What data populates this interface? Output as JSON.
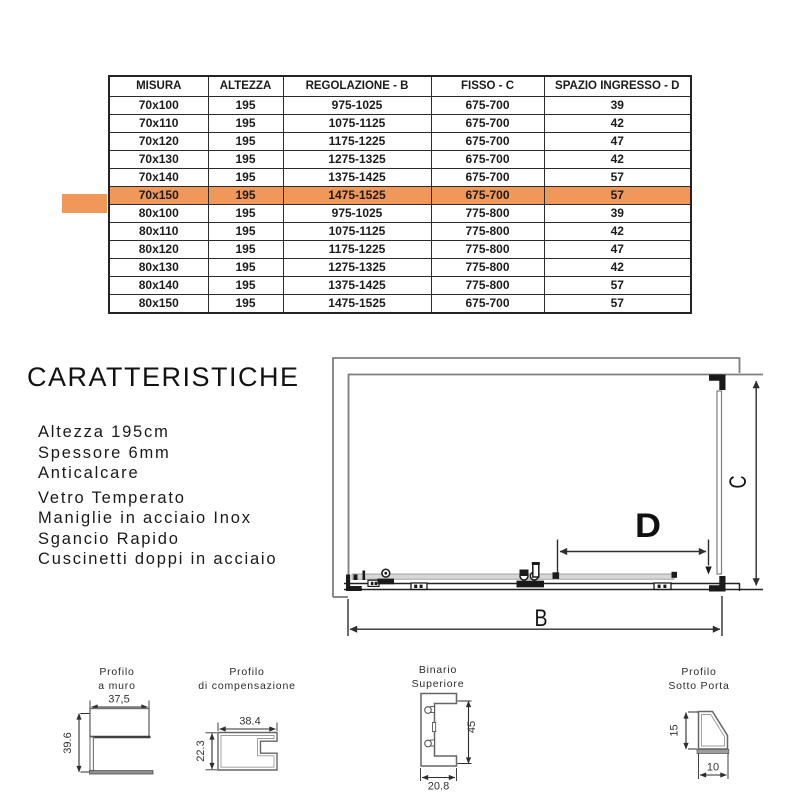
{
  "table": {
    "headers": [
      "MISURA",
      "ALTEZZA",
      "REGOLAZIONE - B",
      "FISSO - C",
      "SPAZIO INGRESSO - D"
    ],
    "rows": [
      [
        "70x100",
        "195",
        "975-1025",
        "675-700",
        "39"
      ],
      [
        "70x110",
        "195",
        "1075-1125",
        "675-700",
        "42"
      ],
      [
        "70x120",
        "195",
        "1175-1225",
        "675-700",
        "47"
      ],
      [
        "70x130",
        "195",
        "1275-1325",
        "675-700",
        "42"
      ],
      [
        "70x140",
        "195",
        "1375-1425",
        "675-700",
        "57"
      ],
      [
        "70x150",
        "195",
        "1475-1525",
        "675-700",
        "57"
      ],
      [
        "80x100",
        "195",
        "975-1025",
        "775-800",
        "39"
      ],
      [
        "80x110",
        "195",
        "1075-1125",
        "775-800",
        "42"
      ],
      [
        "80x120",
        "195",
        "1175-1225",
        "775-800",
        "47"
      ],
      [
        "80x130",
        "195",
        "1275-1325",
        "775-800",
        "42"
      ],
      [
        "80x140",
        "195",
        "1375-1425",
        "775-800",
        "57"
      ],
      [
        "80x150",
        "195",
        "1475-1525",
        "675-700",
        "57"
      ]
    ],
    "highlighted_row_index": 5,
    "highlighted_row": "70x150",
    "highlight_color": "#F0975A"
  },
  "caratteristiche": {
    "title": "CARATTERISTICHE",
    "items": [
      "Altezza 195cm",
      "Spessore 6mm",
      "Anticalcare",
      "Vetro Temperato",
      "Maniglie in acciaio Inox",
      "Sgancio Rapido",
      "Cuscinetti doppi in acciaio"
    ]
  },
  "diagram": {
    "labels": {
      "b": "B",
      "c": "C",
      "d": "D"
    }
  },
  "profiles": [
    {
      "title1": "Profilo",
      "title2": "a muro",
      "dim_width": "37,5",
      "dim_height": "39.6"
    },
    {
      "title1": "Profilo",
      "title2": "di compensazione",
      "dim_width": "38.4",
      "dim_height": "22.3"
    },
    {
      "title1": "Binario",
      "title2": "Superiore",
      "dim_width": "20.8",
      "dim_height": "45"
    },
    {
      "title1": "Profilo",
      "title2": "Sotto Porta",
      "dim_width": "10",
      "dim_height": "15"
    }
  ]
}
